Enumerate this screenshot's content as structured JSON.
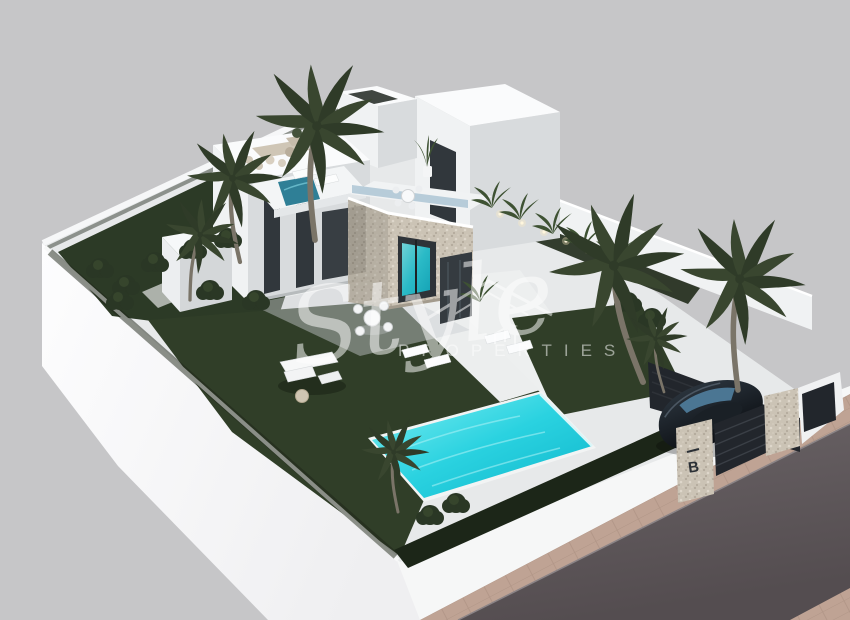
{
  "scene": {
    "description": "Aerial 3D architectural render of a modern two-storey white villa with stone cube, garden, palm trees, turquoise pool, carport with black car, and street corner",
    "watermark": {
      "script": "Style",
      "caption": "PROPERTIES"
    },
    "gate_sign": {
      "letter": "B"
    },
    "colors": {
      "background": "#c6c6c8",
      "plot_base": "#e7e9ea",
      "patio": "#edeff0",
      "outer_face": "#fbfcfd",
      "wall_lit": "#f0f2f3",
      "wall_top": "#fafbfc",
      "wall_shade": "#d8dbdd",
      "stone": "#cbc3b5",
      "stone_shade": "#b4ac9e",
      "lawn": "#303e28",
      "garden_lawn": "#2c3a26",
      "hedge": "#1c2618",
      "planting_bed": "#242e1d",
      "palm_frond": "#39462f",
      "palm_trunk": "#7a7468",
      "pool_light": "#7deef2",
      "pool_mid": "#2ad2e0",
      "pool_deep": "#0fb6cb",
      "plunge_pool": "#2f7f96",
      "window_glass": "#31373c",
      "road_light": "#6b6467",
      "road": "#544d50",
      "sidewalk": "#bfa394",
      "paver_line": "#a98e7e",
      "car_body_light": "#2a333c",
      "car_body_dark": "#0c0f13",
      "car_glass": "#4e7a99",
      "gate_dark": "#22262c",
      "sign_text": "#2b3036",
      "watermark_white": "#ffffff"
    }
  }
}
